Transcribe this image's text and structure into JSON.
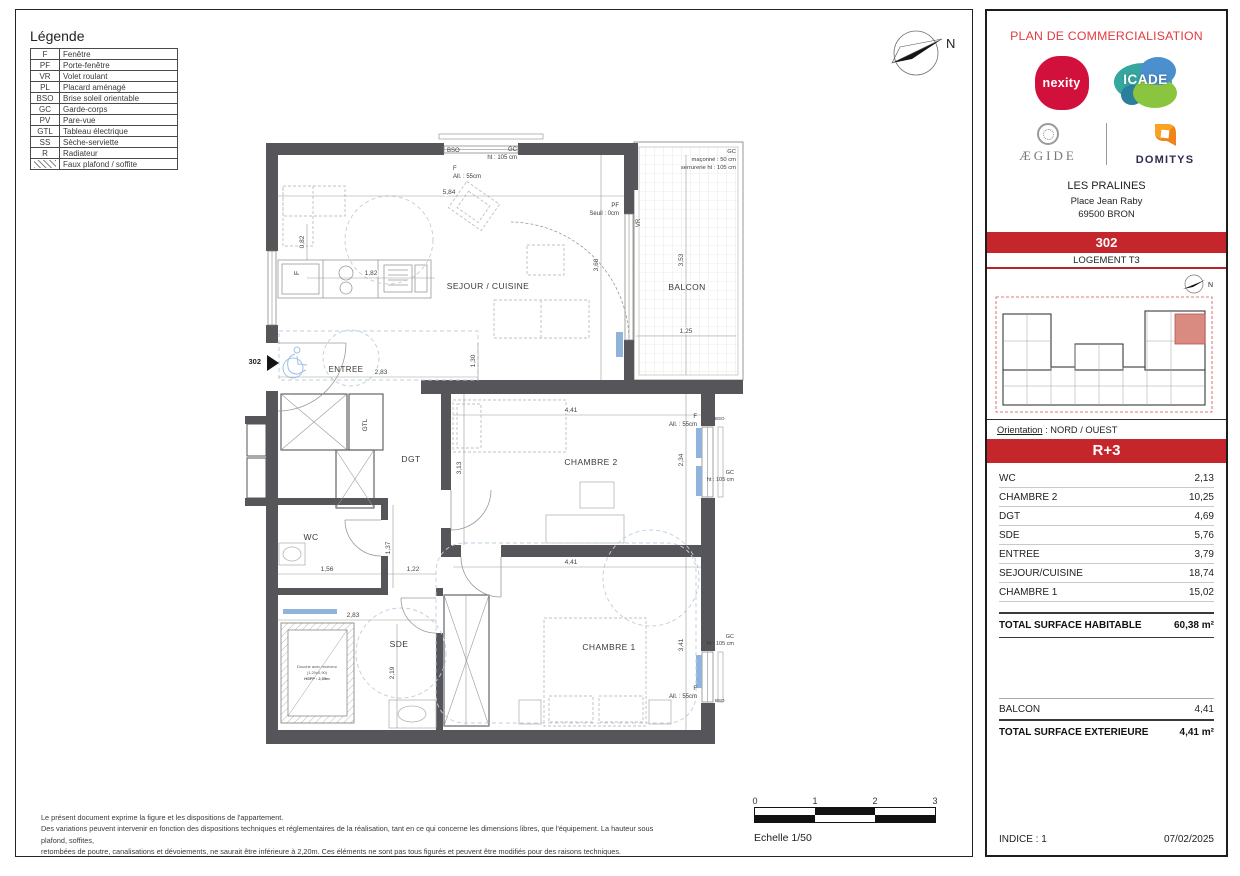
{
  "colors": {
    "red_bar": "#c4262c",
    "title_red": "#e23a3f",
    "wall": "#56565a",
    "accent_blue": "#8fb4dc",
    "keyplan_unit": "#d98b82"
  },
  "north_label": "N",
  "legend": {
    "title": "Légende",
    "items": [
      {
        "abbr": "F",
        "label": "Fenêtre"
      },
      {
        "abbr": "PF",
        "label": "Porte-fenêtre"
      },
      {
        "abbr": "VR",
        "label": "Volet roulant"
      },
      {
        "abbr": "PL",
        "label": "Placard aménagé"
      },
      {
        "abbr": "BSO",
        "label": "Brise soleil orientable"
      },
      {
        "abbr": "GC",
        "label": "Garde-corps"
      },
      {
        "abbr": "PV",
        "label": "Pare-vue"
      },
      {
        "abbr": "GTL",
        "label": "Tableau électrique"
      },
      {
        "abbr": "SS",
        "label": "Sèche-serviette"
      },
      {
        "abbr": "R",
        "label": "Radiateur"
      },
      {
        "abbr": "",
        "label": "Faux plafond / soffite"
      }
    ]
  },
  "plan": {
    "unit_marker": "302",
    "rooms": {
      "sejour": "SEJOUR / CUISINE",
      "balcon": "BALCON",
      "entree": "ENTREE",
      "dgt": "DGT",
      "chambre2": "CHAMBRE 2",
      "wc": "WC",
      "sde": "SDE",
      "chambre1": "CHAMBRE 1"
    },
    "annotations": {
      "bso": "BSO",
      "gc": "GC",
      "ht105": "ht : 105 cm",
      "f": "F",
      "all55": "All. : 55cm",
      "pf": "PF",
      "seuil": "Seuil : 0cm",
      "vr": "VR",
      "gtl": "GTL",
      "maconne": "maçonné : 50 cm",
      "serrurerie": "serrurerie ht : 105 cm",
      "shower1": "Douche avec receveur",
      "shower2": "(1,20x0,90)",
      "shower3": "HSFP : 2,05m"
    },
    "dims": {
      "d584": "5,84",
      "d368": "3,68",
      "d353": "3,53",
      "d125": "1,25",
      "d082": "0,82",
      "d182": "1,82",
      "d130": "1,30",
      "d283e": "2,83",
      "d313": "3,13",
      "d441c2": "4,41",
      "d234": "2,34",
      "d137": "1,37",
      "d156": "1,56",
      "d122": "1,22",
      "d283s": "2,83",
      "d219": "2,19",
      "d441c1": "4,41",
      "d341": "3,41"
    }
  },
  "sidebar": {
    "title": "PLAN DE COMMERCIALISATION",
    "logos": {
      "nexity": "nexity",
      "icade": "ICADE",
      "aegide": "ÆGIDE",
      "domitys": "DOMITYS"
    },
    "project": {
      "name": "LES PRALINES",
      "address1": "Place Jean Raby",
      "address2": "69500 BRON"
    },
    "unit_number": "302",
    "unit_type": "LOGEMENT T3",
    "orientation_label": "Orientation",
    "orientation_value": ": NORD / OUEST",
    "floor": "R+3",
    "areas": [
      {
        "label": "WC",
        "value": "2,13"
      },
      {
        "label": "CHAMBRE 2",
        "value": "10,25"
      },
      {
        "label": "DGT",
        "value": "4,69"
      },
      {
        "label": "SDE",
        "value": "5,76"
      },
      {
        "label": "ENTREE",
        "value": "3,79"
      },
      {
        "label": "SEJOUR/CUISINE",
        "value": "18,74"
      },
      {
        "label": "CHAMBRE 1",
        "value": "15,02"
      }
    ],
    "total_habitable_label": "TOTAL SURFACE HABITABLE",
    "total_habitable_value": "60,38 m²",
    "balcon_label": "BALCON",
    "balcon_value": "4,41",
    "total_ext_label": "TOTAL SURFACE EXTERIEURE",
    "total_ext_value": "4,41 m²",
    "indice": "INDICE : 1",
    "date": "07/02/2025"
  },
  "footer": {
    "disclaimer_line1": "Le présent document exprime la figure et les dispositions de l'appartement.",
    "disclaimer_line2": "Des variations peuvent intervenir en fonction des dispositions techniques et réglementaires de la réalisation, tant en ce qui concerne les dimensions libres, que l'équipement. La hauteur sous plafond, soffites,",
    "disclaimer_line3": "retombées de poutre, canalisations et dévoiements, ne saurait être inférieure à 2,20m. Ces éléments ne sont pas tous figurés et peuvent être modifiés pour des raisons techniques.",
    "scale_label": "Echelle 1/50",
    "scale_ticks": [
      "0",
      "1",
      "2",
      "3"
    ]
  }
}
